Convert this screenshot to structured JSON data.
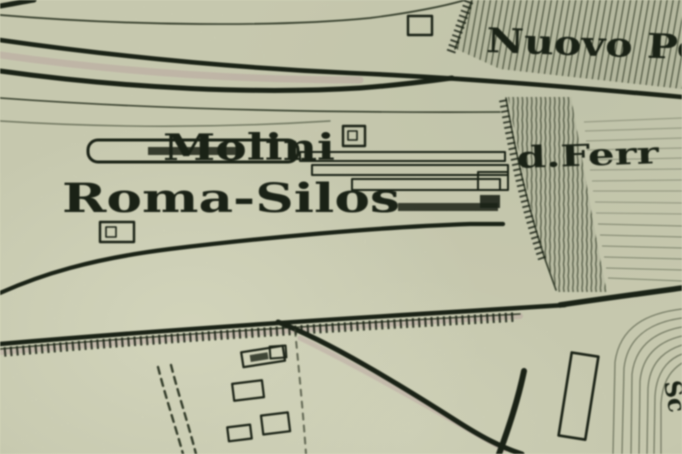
{
  "map": {
    "type": "historic-city-map-photo-crop",
    "labels": {
      "nuovo_po": "Nuovo Po",
      "molini": "Molini",
      "roma_silos": "Roma-Silos",
      "d_ferr": "d.Ferr",
      "edge_fragment": "Sc"
    },
    "features": [
      "converging-railway-lines-upper-left",
      "hatched-embankment-nuovo-po",
      "hatched-band-ferrovia",
      "molini-roma-silos-buildings",
      "comb-ticked-railway-line",
      "curved-road-to-bottom",
      "dashed-sidings",
      "small-building-footprints",
      "curved-track-bundle-bottom-right"
    ],
    "colors": {
      "paper": "#d6d8bc",
      "paper_light": "#e4e6cc",
      "ink": "#1d2518",
      "ink_soft": "#39422f",
      "hatch": "#49523c",
      "fringe": "#b98ca0"
    }
  }
}
